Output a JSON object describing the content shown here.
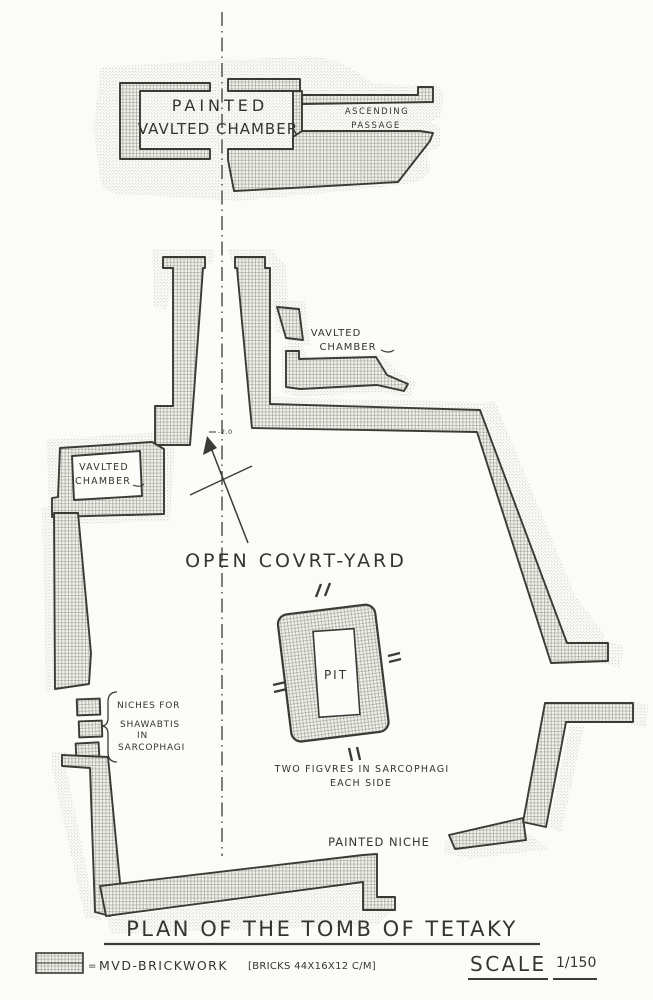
{
  "document": {
    "title": "PLAN OF THE TOMB OF TETAKY"
  },
  "plan": {
    "burial_chamber": {
      "line1": "PAINTED",
      "line2": "VAVLTED CHAMBER"
    },
    "ascending_passage": {
      "line1": "ASCENDING",
      "line2": "PASSAGE"
    },
    "right_vaulted_chamber": {
      "line1": "VAVLTED",
      "line2": "CHAMBER"
    },
    "left_vaulted_chamber": {
      "line1": "VAVLTED",
      "line2": "CHAMBER"
    },
    "courtyard": {
      "label": "OPEN COVRT-YARD"
    },
    "pit": {
      "label": "PIT",
      "note_line1": "TWO FIGVRES IN SARCOPHAGI",
      "note_line2": "EACH SIDE"
    },
    "niches": {
      "line1": "NICHES FOR",
      "line2": "SHAWABTIS",
      "line3": "IN",
      "line4": "SARCOPHAGI"
    },
    "painted_niche": {
      "label": "PAINTED NICHE"
    },
    "north_arrow": {
      "label": "-2.0"
    }
  },
  "legend": {
    "equals": "=",
    "brickwork": "MVD-BRICKWORK",
    "bricks": "[BRICKS 44X16X12 C/M]",
    "scale_label": "SCALE",
    "scale_value": "1/150"
  },
  "colors": {
    "ink": "#3b3b35",
    "paper": "#fbfbf8",
    "hatch_line": "#93938b",
    "stipple_dot": "#b5b5ae"
  }
}
